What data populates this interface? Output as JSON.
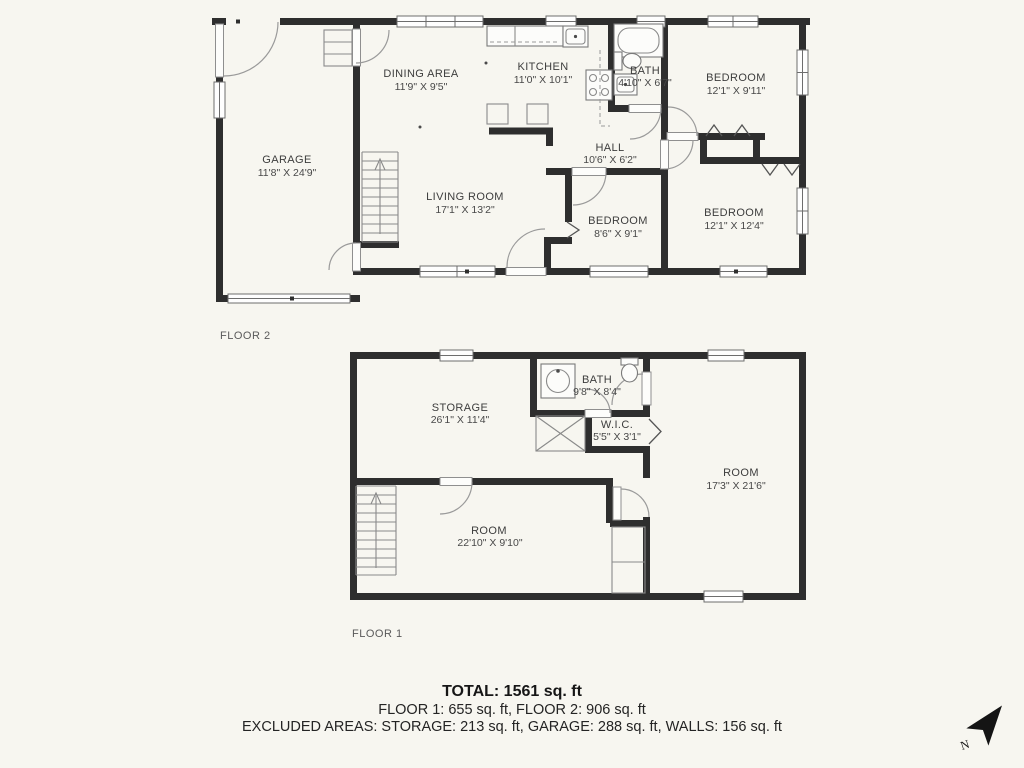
{
  "colors": {
    "background": "#f7f6f0",
    "wall": "#2e2e2e",
    "label_text": "#3d3d3d",
    "summary_text": "#161616"
  },
  "floor2": {
    "label": "FLOOR 2",
    "rooms": {
      "garage": {
        "name": "GARAGE",
        "dims": "11'8\" X 24'9\""
      },
      "dining": {
        "name": "DINING AREA",
        "dims": "11'9\" X 9'5\""
      },
      "kitchen": {
        "name": "KITCHEN",
        "dims": "11'0\" X 10'1\""
      },
      "bath": {
        "name": "BATH",
        "dims": "4'10\" X 6'7\""
      },
      "bedroom_top": {
        "name": "BEDROOM",
        "dims": "12'1\" X 9'11\""
      },
      "hall": {
        "name": "HALL",
        "dims": "10'6\" X 6'2\""
      },
      "living": {
        "name": "LIVING ROOM",
        "dims": "17'1\" X 13'2\""
      },
      "bedroom_small": {
        "name": "BEDROOM",
        "dims": "8'6\" X 9'1\""
      },
      "bedroom_right": {
        "name": "BEDROOM",
        "dims": "12'1\" X 12'4\""
      }
    }
  },
  "floor1": {
    "label": "FLOOR 1",
    "rooms": {
      "storage": {
        "name": "STORAGE",
        "dims": "26'1\" X 11'4\""
      },
      "bath": {
        "name": "BATH",
        "dims": "9'8\" X 8'4\""
      },
      "wic": {
        "name": "W.I.C.",
        "dims": "5'5\" X 3'1\""
      },
      "room_right": {
        "name": "ROOM",
        "dims": "17'3\" X 21'6\""
      },
      "room_bottom": {
        "name": "ROOM",
        "dims": "22'10\" X 9'10\""
      }
    }
  },
  "summary": {
    "total": "TOTAL: 1561 sq. ft",
    "floors": "FLOOR 1: 655 sq. ft, FLOOR 2: 906 sq. ft",
    "excluded": "EXCLUDED AREAS: STORAGE: 213 sq. ft, GARAGE: 288 sq. ft, WALLS: 156 sq. ft"
  },
  "compass": {
    "north_label": "N"
  }
}
